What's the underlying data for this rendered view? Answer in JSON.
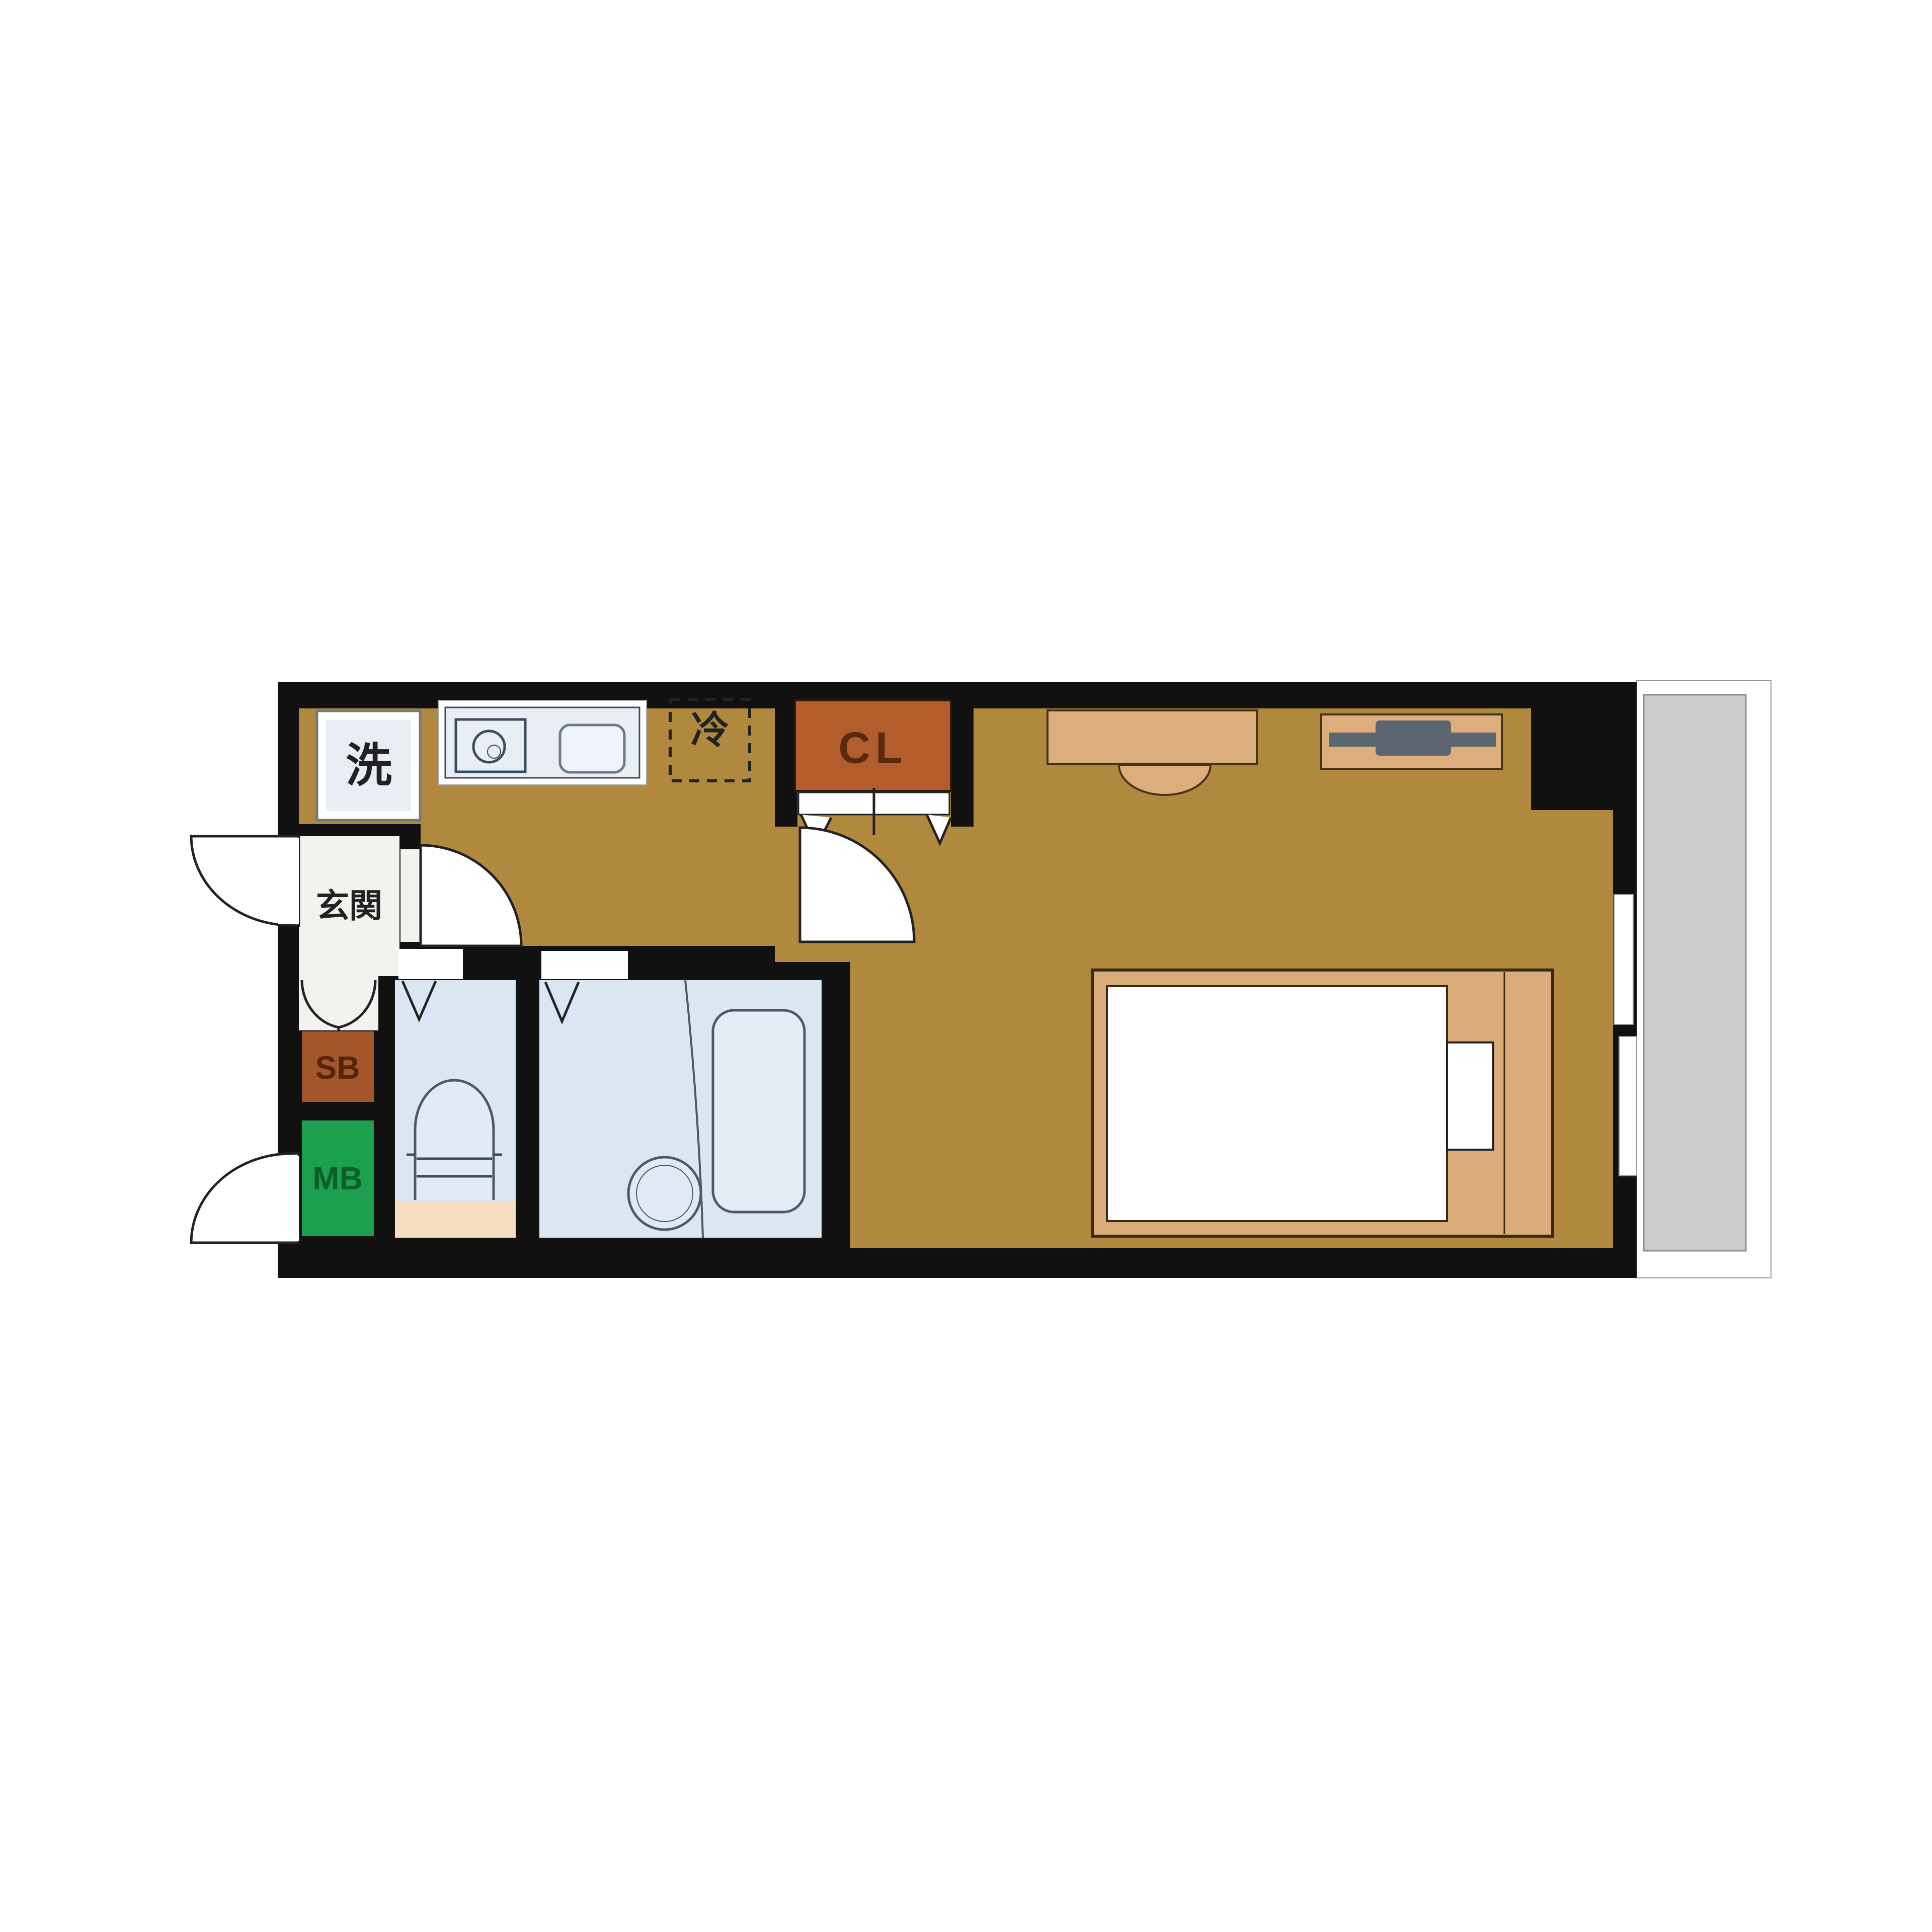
{
  "floorplan": {
    "type": "japanese-apartment-floor-plan",
    "labels": {
      "washer": "洗",
      "refrigerator": "冷",
      "closet": "CL",
      "entrance": "玄関",
      "shoe_box": "SB",
      "meter_box": "MB"
    },
    "rooms": {
      "kitchen_corridor": "kitchen corridor",
      "entrance_hall": "genkan",
      "toilet_room": "toilet",
      "bathroom": "unit bath",
      "main_room": "western room",
      "balcony": "balcony"
    },
    "fixtures": [
      "washing-machine-space",
      "kitchen-counter",
      "stove-burner",
      "sink",
      "refrigerator-space",
      "closet",
      "folding-door",
      "swing-doors",
      "toilet",
      "bathtub",
      "bath-drain",
      "desk",
      "chair",
      "tv-board",
      "tv",
      "bed",
      "mattress",
      "pillow",
      "sliding-window"
    ],
    "colors": {
      "background": "#FFFFFF",
      "wall": "#111111",
      "floor": "#B0883E",
      "wet_room": "#DAE7F2",
      "fixture_fill": "#E9EEF4",
      "fixture_stroke": "#3C4C5C",
      "closet_fill": "#B25D2B",
      "closet_text": "#5A2A0C",
      "shoe_box_fill": "#A2562A",
      "shoe_box_text": "#542508",
      "meter_box_fill": "#1CA04D",
      "meter_box_text": "#0A5F28",
      "furniture": "#DCAE7C",
      "tv": "#5C6670",
      "balcony": "#CBCBCB",
      "step_beige": "#F6DFC1",
      "entrance_floor": "#F3F2EF"
    }
  }
}
